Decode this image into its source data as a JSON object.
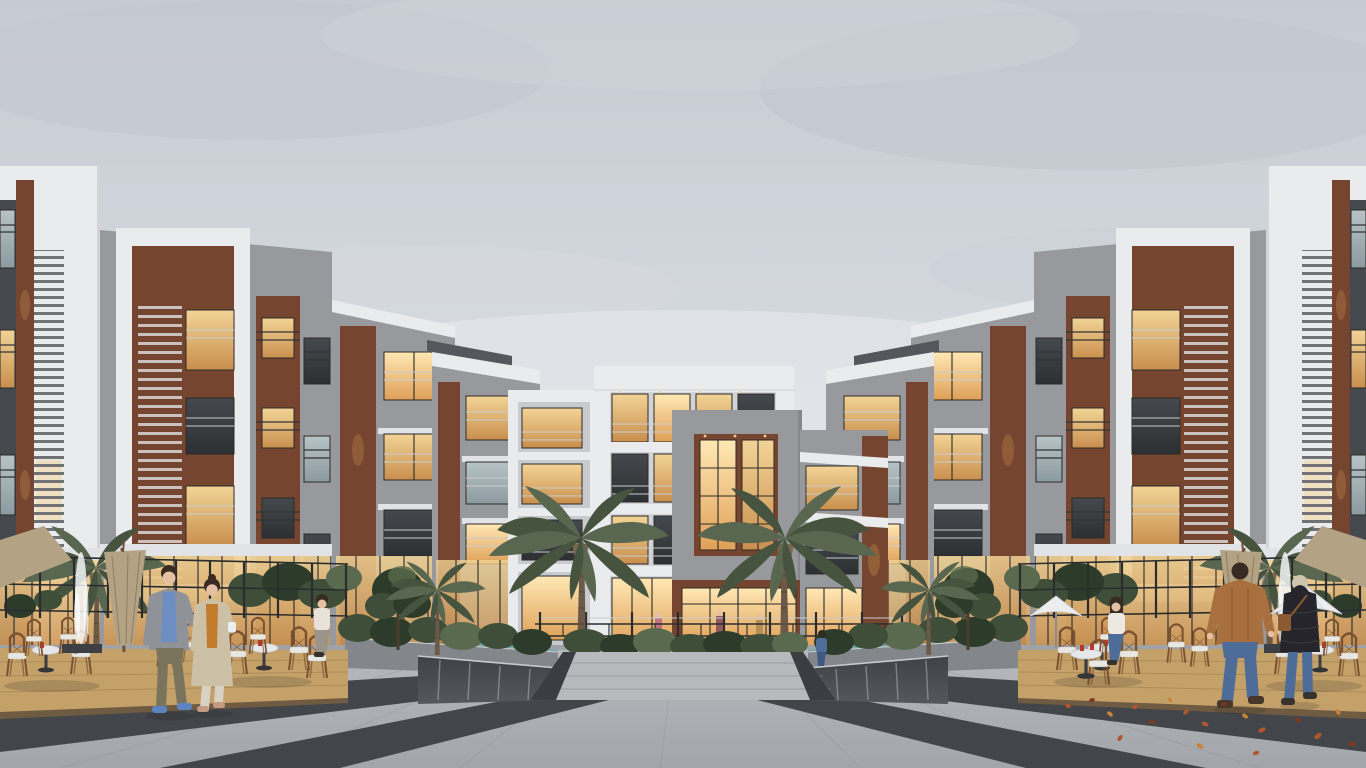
{
  "meta": {
    "title": "Residential courtyard at dusk — architectural rendering",
    "description": "Overcast-dusk architectural rendering of a modern apartment complex: stepped white, gray and brick buildings with warm lit windows enclose a landscaped courtyard with palm trees, hedge planters, mirror water walls, cafe terraces with rattan bistro chairs, and a wide striped stone plaza with people strolling."
  },
  "palette": {
    "sky_top": "#c6cbd3",
    "sky_mid": "#d7dbe1",
    "sky_low": "#e6e8ec",
    "cloud": "#c2c7cf",
    "facade_white": "#eaebed",
    "white_shade": "#d3d4d8",
    "slab": "#e2e3e6",
    "concrete": "#97999c",
    "concrete_dark": "#85878b",
    "concrete_light": "#aaacaf",
    "brick": "#76452f",
    "brick_dark": "#613929",
    "win_frame": "#2c2a27",
    "glow_warm": "#f2d496",
    "glow_amber": "#c98f4e",
    "glow_bright": "#ffe8b4",
    "glow_deep": "#dfa058",
    "glass_cool1": "#b7c3c6",
    "glass_cool2": "#8c9ba0",
    "glass_dark1": "#45494d",
    "glass_dark2": "#2d3033",
    "rail_dark": "#323335",
    "rail_light": "#c8cbce",
    "fence": "#2b2c2e",
    "foliage": "#3e4e38",
    "foliage_dark": "#2d3c2a",
    "foliage_light": "#5a6a4e",
    "palm": "#46543f",
    "palm_light": "#596750",
    "trunk": "#6b5a48",
    "frond_dry": "#79684e",
    "deck": "#c4a169",
    "deck_dark": "#8f7446",
    "plaza_far": "#b7babe",
    "plaza_near": "#a2a5a9",
    "stripe": "#3a3d41",
    "joint": "#8f9297",
    "water_dark": "#3f4347",
    "water_light": "#aeb4b9",
    "pool": "#6fa7a9",
    "umbrella_tan": "#b3a284",
    "umbrella_white": "#ebedef",
    "rattan": "#7c5130",
    "cushion": "#e9e7e2",
    "leaf_rust": "#b0572f",
    "leaf_dark": "#7c3a20",
    "leaf_amber": "#c8823c",
    "skin": "#e6c0a3",
    "hair": "#372b22",
    "jacket_gray": "#8f9298",
    "shirt_blue": "#6d8ec2",
    "pants_olive": "#7b745c",
    "shoe_blue": "#5d83c2",
    "coat_beige": "#ccc0a6",
    "top_mustard": "#c27a2c",
    "pants_cream": "#d8d2c4",
    "heel_tan": "#c49a83",
    "jacket_tan": "#a8703e",
    "jeans": "#4e6c98",
    "puffer": "#25252b",
    "bag_brown": "#8a5a33",
    "shoe_brown": "#49362a",
    "shoe_dark": "#37322e",
    "figure_blue": "#4f6d99",
    "cup_white": "#ecedef",
    "cup_red": "#b8382b"
  },
  "scene": {
    "setting": "Symmetric U-shaped modern residential complex around a courtyard plaza",
    "time_of_day": "overcast dusk, interior lights glowing",
    "buildings": [
      {
        "id": "left-building-complex",
        "description": "Stepped 4-storey blocks receding to center: white frames with louver screens, gray stucco, terracotta brick piers, balconies, lit ground-floor storefronts"
      },
      {
        "id": "center-building",
        "description": "4-storey block with white wrap frame, gray concrete picture-frame volume over brick infill, floor-to-ceiling lit glazing, ground-floor retail behind a decorative iron fence"
      },
      {
        "id": "right-building-complex",
        "description": "Mirror image of the left complex"
      }
    ],
    "vegetation": [
      "two tall palm trees flanking the central walkway",
      "small palms and dark evergreen trees by the terraces",
      "clipped hedges in stone planters",
      "shrub beds behind the cafe fences"
    ],
    "water": [
      "mirror-finish water walls flanking the central steps",
      "thin white fountain jets at the outer cafe terraces",
      "teal pool edge glimpsed behind the planters"
    ],
    "plaza": {
      "paving": "light granite pavers with perspective joints",
      "stripes": "dark basalt bands converging toward the center",
      "litter": "scattered autumn leaves on the right half"
    },
    "cafes": {
      "decking": "sand-colored timber deck terraces on both sides",
      "furniture": "rattan bistro chairs with white cushions, pedestal tables, red cups",
      "umbrellas": [
        "closed tan umbrella on the left terrace",
        "open white umbrellas on the right terrace"
      ]
    },
    "people": [
      {
        "id": "left-man",
        "description": "man strolling with coffee cup — gray blazer, blue shirt, olive trousers, blue sneakers"
      },
      {
        "id": "left-woman",
        "description": "woman strolling — long beige coat over mustard top, cream trousers"
      },
      {
        "id": "right-man",
        "description": "man walking away — tan leather jacket, blue jeans, brown shoes"
      },
      {
        "id": "right-woman",
        "description": "woman walking away — black puffer jacket, light hair, brown shoulder bag, jeans"
      },
      {
        "id": "seated-woman-left",
        "description": "woman seated at a cafe table on the left terrace"
      },
      {
        "id": "seated-woman-right",
        "description": "woman in white sweater and jeans seated at a cafe table on the right terrace"
      },
      {
        "id": "pool-figure",
        "description": "person in blue seated by the right water feature"
      }
    ]
  }
}
